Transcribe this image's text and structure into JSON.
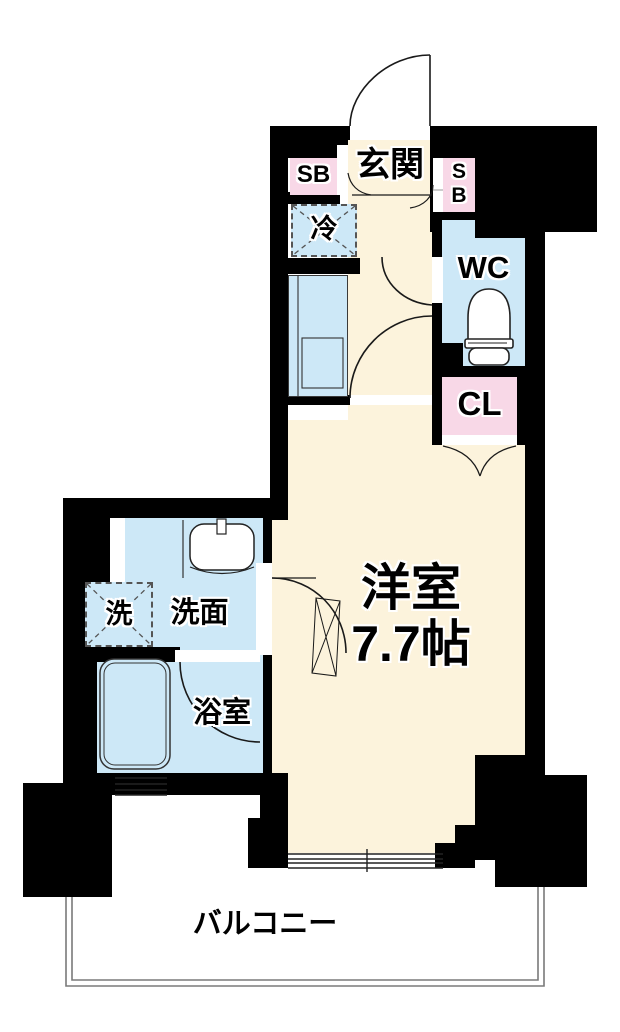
{
  "title": "apartment-floorplan",
  "labels": {
    "entrance": "玄関",
    "shoebox_left": "SB",
    "shoebox_right_s": "S",
    "shoebox_right_b": "B",
    "refrigerator": "冷",
    "toilet": "WC",
    "closet": "CL",
    "main_room_name": "洋室",
    "main_room_size": "7.7帖",
    "washer": "洗",
    "washroom": "洗面",
    "bathroom": "浴室",
    "balcony": "バルコニー"
  },
  "colors": {
    "floor_cream": "#fcf3dc",
    "wet_blue": "#cde8f7",
    "storage_pink": "#f8d8e7",
    "wall_black": "#000000",
    "line_dark": "#1a1a1a",
    "balcony_line": "#7a7a7a"
  }
}
